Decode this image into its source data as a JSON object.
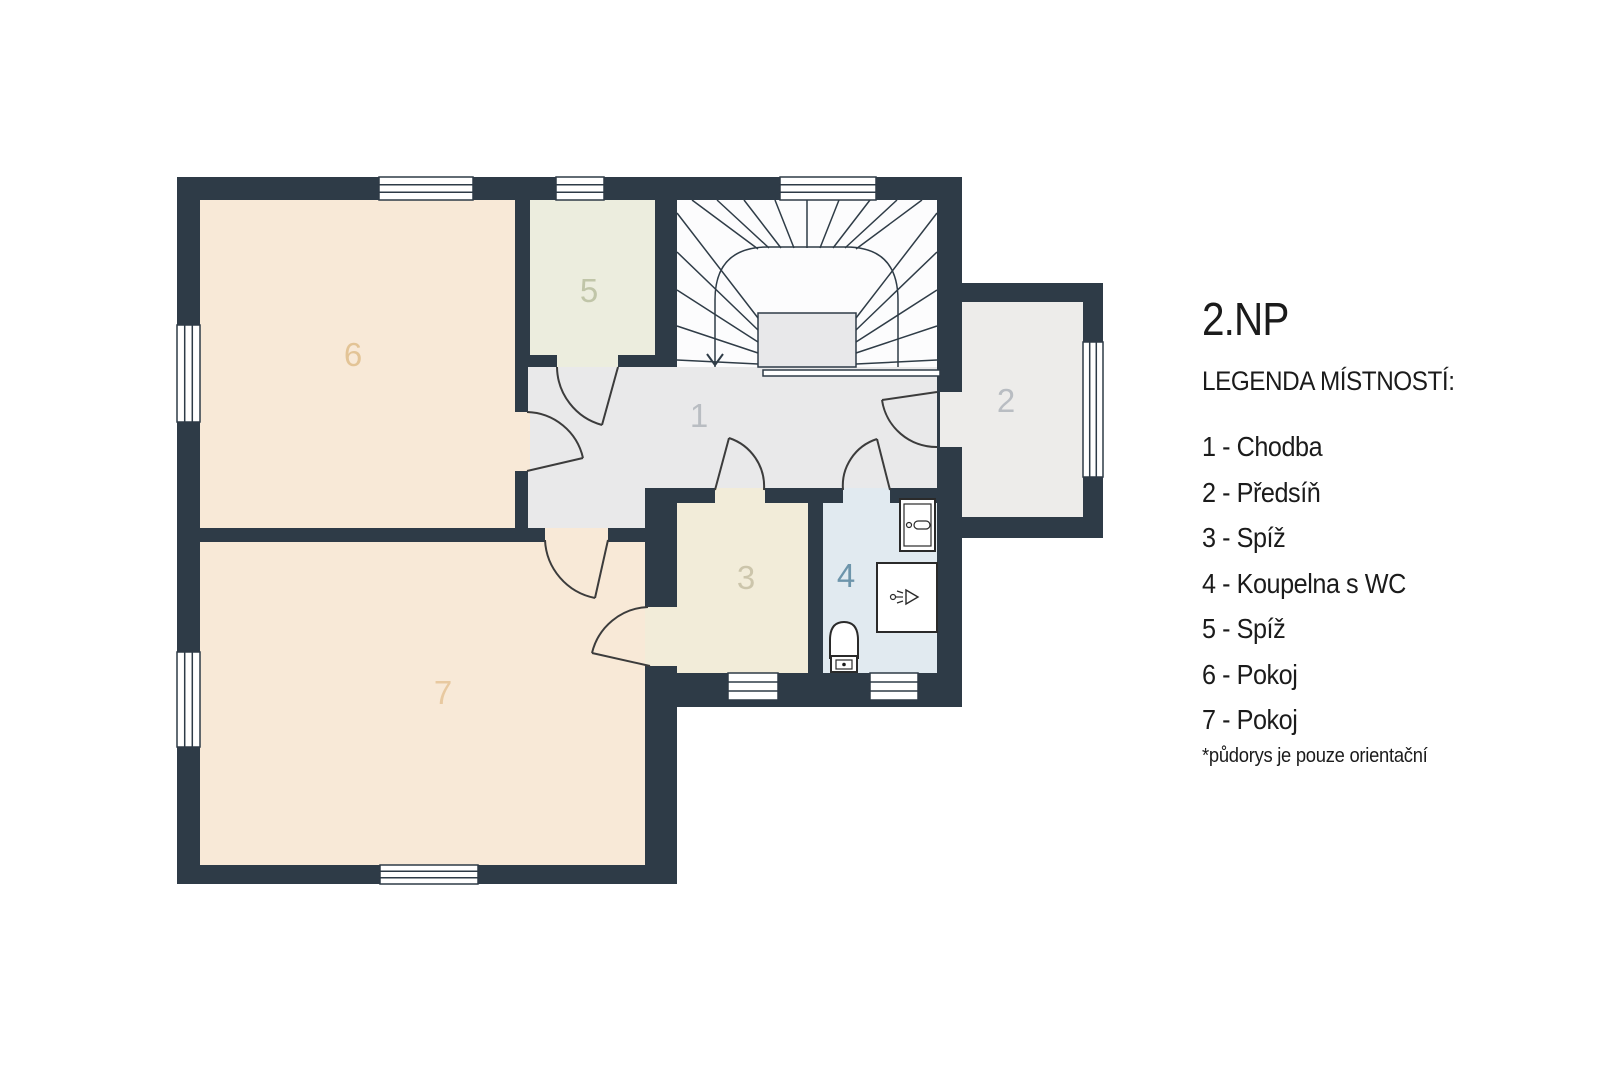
{
  "title": "2.NP",
  "legend": {
    "heading": "LEGENDA MÍSTNOSTÍ:",
    "items": [
      "1 - Chodba",
      "2 - Předsíň",
      "3 - Spíž",
      "4 - Koupelna s WC",
      "5 - Spíž",
      "6 - Pokoj",
      "7 - Pokoj"
    ],
    "footnote": "*půdorys je pouze orientační"
  },
  "colors": {
    "wall": "#2e3b47",
    "room_peach": "#f8e9d7",
    "room5": "#ecedde",
    "room3": "#f2ecd9",
    "room4": "#e1eaf0",
    "room2": "#edecea",
    "hall": "#e9e9ea",
    "stairs": "#fcfcfd",
    "stair_void": "#e8e8ea",
    "window_fill": "#ffffff",
    "door_stroke": "#3c3c3c"
  },
  "plan": {
    "labels": [
      {
        "text": "1",
        "color": "#b9bdc2"
      },
      {
        "text": "2",
        "color": "#b9bdc2"
      },
      {
        "text": "3",
        "color": "#ccc5ab"
      },
      {
        "text": "4",
        "color": "#6d95ab"
      },
      {
        "text": "5",
        "color": "#c0c5a8"
      },
      {
        "text": "6",
        "color": "#e3c496"
      },
      {
        "text": "7",
        "color": "#e8c9a0"
      }
    ]
  }
}
